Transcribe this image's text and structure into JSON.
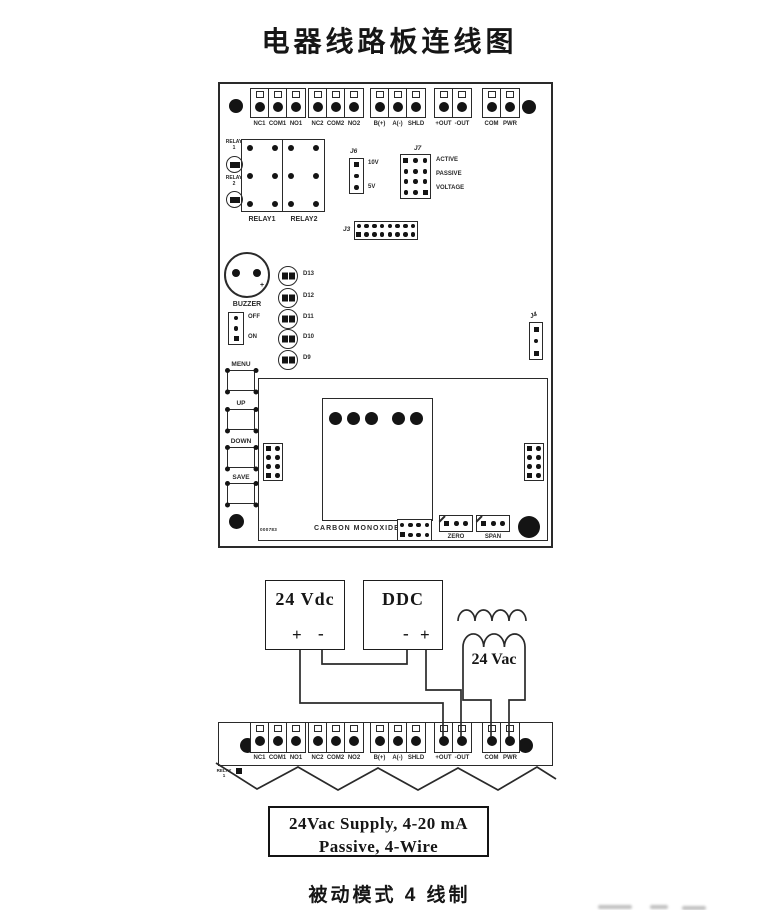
{
  "title": "电器线路板连线图",
  "footer_caption": "被动模式 4 线制",
  "board": {
    "terminal_labels": [
      "NC1",
      "COM1",
      "NO1",
      "NC2",
      "COM2",
      "NO2",
      "B(+)",
      "A(-)",
      "SHLD",
      "+OUT",
      "-OUT",
      "COM",
      "PWR"
    ],
    "relay_indicators": [
      {
        "line1": "RELAY",
        "line2": "1"
      },
      {
        "line1": "RELAY",
        "line2": "2"
      }
    ],
    "relay_boxes": [
      "RELAY1",
      "RELAY2"
    ],
    "j6": {
      "label": "J6",
      "top_option": "10V",
      "bottom_option": "5V"
    },
    "j7": {
      "label": "J7",
      "options": [
        "ACTIVE",
        "PASSIVE",
        "VOLTAGE"
      ]
    },
    "j3_label": "J3",
    "j4_label": "J4",
    "buzzer": {
      "label": "BUZZER",
      "off": "OFF",
      "on": "ON",
      "plus": "+"
    },
    "led_labels": [
      "D13",
      "D12",
      "D11",
      "D10",
      "D9"
    ],
    "buttons": [
      "MENU",
      "UP",
      "DOWN",
      "SAVE"
    ],
    "sensor_label": "CARBON MONOXIDE",
    "board_code": "000783",
    "trimmer_labels": [
      "ZERO",
      "SPAN"
    ]
  },
  "wiring": {
    "psu_label": "24 Vdc",
    "ddc_label": "DDC",
    "transformer_label": "24 Vac",
    "plus": "+",
    "minus": "-",
    "torn_note_line1": "RELAY",
    "torn_note_line2": "1",
    "caption_line1": "24Vac Supply, 4-20 mA",
    "caption_line2": "Passive, 4-Wire"
  },
  "colors": {
    "ink": "#2a2a2a",
    "paper": "#ffffff"
  }
}
